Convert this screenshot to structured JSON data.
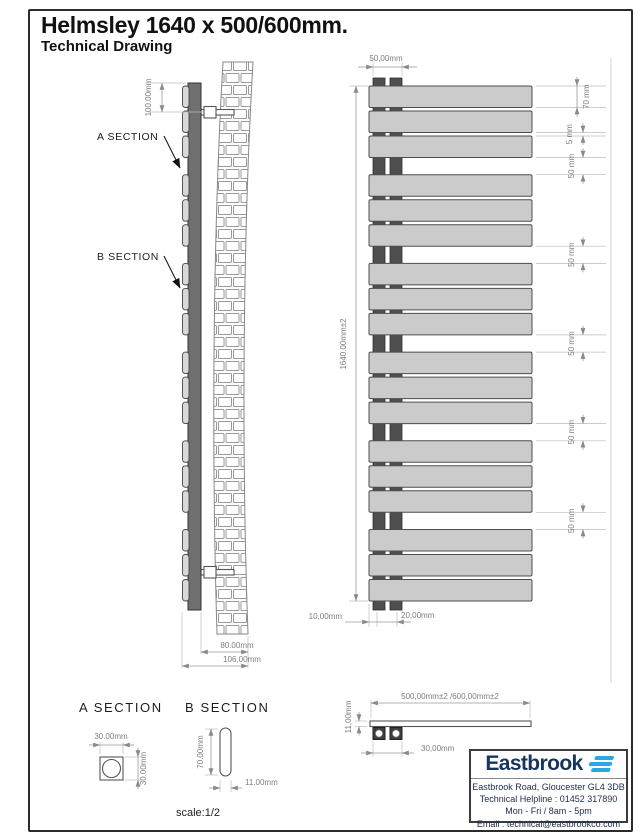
{
  "title": "Helmsley 1640 x 500/600mm.",
  "subtitle": "Technical Drawing",
  "side_view": {
    "dim_bracket_offset": "100.00mm",
    "label_a": "A SECTION",
    "label_b": "B SECTION",
    "dim_depth_inner": "80.00mm",
    "dim_depth_total": "106,00mm"
  },
  "front_view": {
    "dim_pipe_centres": "50,00mm",
    "dim_height": "1640.00mm±2",
    "dim_panel": "70 mm",
    "dim_gap_small": "5 mm",
    "dim_gap": "50 mm",
    "dim_bottom_left": "10,00mm",
    "dim_bottom_right": "20,00mm"
  },
  "section_a": {
    "heading": "A SECTION",
    "dim_width": "30.00mm",
    "dim_height": "30.00mm"
  },
  "section_b": {
    "heading": "B SECTION",
    "dim_height": "70.00mm",
    "dim_width": "11.00mm"
  },
  "scale_label": "scale:1/2",
  "top_view": {
    "dim_width": "500,00mm±2 /600,00mm±2",
    "dim_thickness": "11,00mm",
    "dim_pipe_offset": "30,00mm"
  },
  "brand": {
    "logo_text": "Eastbrook",
    "address": "Eastbrook Road, Gloucester GL4 3DB",
    "helpline": "Technical Helpline : 01452 317890",
    "hours": "Mon - Fri / 8am - 5pm",
    "email": "Email : technical@eastbrookco.com"
  },
  "colors": {
    "accent_blue": "#2aa9e0",
    "brand_navy": "#16355e",
    "panel_gray": "#cbcbcb",
    "tube_gray": "#4f4f4f",
    "dim_line_gray": "#9a9a9a"
  }
}
